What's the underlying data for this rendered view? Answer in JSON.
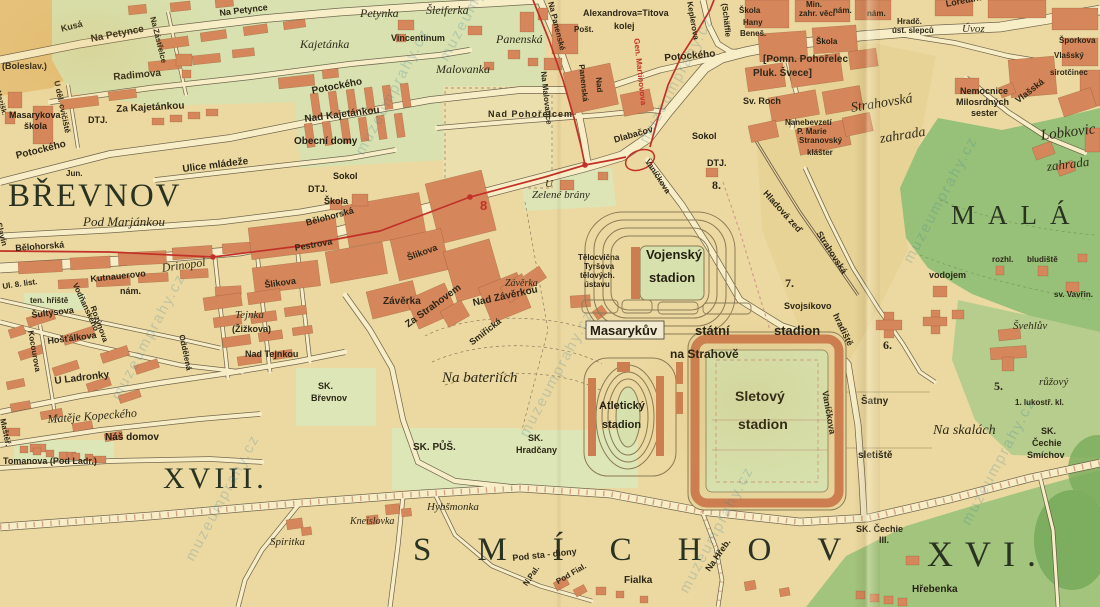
{
  "map": {
    "type": "historical-city-plan",
    "city_area": "Praha – Břevnov, Strahov, Smíchov, Malá Strana",
    "tram_line_number": "8",
    "watermark": {
      "text": "muzeumprahy.cz",
      "spots": [
        [
          108,
          395
        ],
        [
          352,
          150
        ],
        [
          636,
          138
        ],
        [
          516,
          432
        ],
        [
          182,
          556
        ],
        [
          900,
          258
        ],
        [
          676,
          588
        ],
        [
          436,
          56
        ],
        [
          958,
          520
        ]
      ]
    },
    "district_labels": [
      "BŘEVNOV",
      "MALÁ",
      "SMÍCHOV",
      "XVI.",
      "XVIII."
    ],
    "district_numbers": [
      "5.",
      "6.",
      "7.",
      "8."
    ],
    "colors": {
      "paper": "#ecd9a1",
      "block_green": "#d8e1af",
      "field_green": "#dde6b6",
      "park_green": "#97c078",
      "dark_park": "#7dad5e",
      "building": "#d5865a",
      "stand": "#cd7e50",
      "road": "#f7eec8",
      "tram_red": "#c23128",
      "ink": "#2d2718"
    }
  },
  "labels": [
    {
      "t": "BŘEVNOV",
      "x": 8,
      "y": 180,
      "fs": 33,
      "c": "big",
      "ls": 2
    },
    {
      "t": "MALÁ",
      "x": 951,
      "y": 202,
      "fs": 27,
      "c": "big",
      "ls": 13
    },
    {
      "t": "SMÍCHOV",
      "x": 413,
      "y": 534,
      "fs": 33,
      "c": "big",
      "ls": 46
    },
    {
      "t": "XVI.",
      "x": 927,
      "y": 536,
      "fs": 36,
      "c": "big",
      "ls": 12
    },
    {
      "t": "XVIII.",
      "x": 163,
      "y": 464,
      "fs": 30,
      "c": "big",
      "ls": 4
    },
    {
      "t": "Petynka",
      "x": 360,
      "y": 7,
      "fs": 12,
      "c": "it"
    },
    {
      "t": "Šleiferka",
      "x": 426,
      "y": 4,
      "fs": 12,
      "c": "it"
    },
    {
      "t": "Kajetánka",
      "x": 300,
      "y": 38,
      "fs": 12,
      "c": "it"
    },
    {
      "t": "Panenská",
      "x": 496,
      "y": 33,
      "fs": 12,
      "c": "it"
    },
    {
      "t": "Malovanka",
      "x": 436,
      "y": 63,
      "fs": 12,
      "c": "it"
    },
    {
      "t": "Pod Marjánkou",
      "x": 83,
      "y": 215,
      "fs": 13,
      "c": "it"
    },
    {
      "t": "Drinopol",
      "x": 161,
      "y": 262,
      "fs": 12,
      "c": "it",
      "r": -8
    },
    {
      "t": "Tejnka",
      "x": 235,
      "y": 310,
      "fs": 11,
      "c": "it"
    },
    {
      "t": "Spiritka",
      "x": 270,
      "y": 537,
      "fs": 11,
      "c": "it"
    },
    {
      "t": "Kneislovka",
      "x": 350,
      "y": 517,
      "fs": 10,
      "c": "it"
    },
    {
      "t": "Hybšmonka",
      "x": 427,
      "y": 502,
      "fs": 11,
      "c": "it"
    },
    {
      "t": "Na bateriích",
      "x": 442,
      "y": 371,
      "fs": 15,
      "c": "it"
    },
    {
      "t": "Na skalách",
      "x": 933,
      "y": 424,
      "fs": 14,
      "c": "it"
    },
    {
      "t": "růžový",
      "x": 1039,
      "y": 377,
      "fs": 11,
      "c": "it"
    },
    {
      "t": "Švehlův",
      "x": 1013,
      "y": 321,
      "fs": 11,
      "c": "it"
    },
    {
      "t": "Strahovská",
      "x": 850,
      "y": 102,
      "fs": 14,
      "c": "it",
      "r": -9
    },
    {
      "t": "zahrada",
      "x": 879,
      "y": 133,
      "fs": 14,
      "c": "it",
      "r": -9
    },
    {
      "t": "Lobkovic",
      "x": 1040,
      "y": 129,
      "fs": 15,
      "c": "it",
      "r": -7
    },
    {
      "t": "zahrada",
      "x": 1046,
      "y": 160,
      "fs": 13,
      "c": "it",
      "r": -7
    },
    {
      "t": "U",
      "x": 545,
      "y": 179,
      "fs": 11,
      "c": "it"
    },
    {
      "t": "Zelené brány",
      "x": 532,
      "y": 190,
      "fs": 11,
      "c": "it"
    },
    {
      "t": "Závěrka",
      "x": 505,
      "y": 279,
      "fs": 10,
      "c": "it"
    },
    {
      "t": "Úvoz",
      "x": 962,
      "y": 24,
      "fs": 11,
      "c": "it"
    },
    {
      "t": "Matěje Kopeckého",
      "x": 47,
      "y": 413,
      "fs": 12,
      "c": "it",
      "r": -4
    },
    {
      "t": "Kusá",
      "x": 60,
      "y": 25,
      "fs": 9,
      "c": "st",
      "r": -14
    },
    {
      "t": "Na Petynce",
      "x": 90,
      "y": 35,
      "fs": 10,
      "c": "st",
      "r": -11
    },
    {
      "t": "Na Petynce",
      "x": 219,
      "y": 9,
      "fs": 9,
      "c": "st",
      "r": -7
    },
    {
      "t": "(Boleslav.)",
      "x": 2,
      "y": 62,
      "fs": 9,
      "c": "st"
    },
    {
      "t": "Radimova",
      "x": 113,
      "y": 73,
      "fs": 10,
      "c": "st",
      "r": -5
    },
    {
      "t": "Za Kajetánkou",
      "x": 116,
      "y": 105,
      "fs": 10,
      "c": "st",
      "r": -3
    },
    {
      "t": "Vincentinum",
      "x": 391,
      "y": 34,
      "fs": 9,
      "c": "st"
    },
    {
      "t": "Potockého",
      "x": 311,
      "y": 87,
      "fs": 10,
      "c": "st",
      "r": -11
    },
    {
      "t": "Nad Kajetánkou",
      "x": 304,
      "y": 115,
      "fs": 10,
      "c": "st",
      "r": -7
    },
    {
      "t": "Ulice mládeže",
      "x": 182,
      "y": 165,
      "fs": 10,
      "c": "st",
      "r": -7
    },
    {
      "t": "Potockého",
      "x": 15,
      "y": 152,
      "fs": 10,
      "c": "st",
      "r": -14
    },
    {
      "t": "Jun.",
      "x": 66,
      "y": 170,
      "fs": 8,
      "c": "st"
    },
    {
      "t": "Bělohorská",
      "x": 15,
      "y": 244,
      "fs": 9,
      "c": "st",
      "r": -4
    },
    {
      "t": "Bělohorská",
      "x": 305,
      "y": 219,
      "fs": 9,
      "c": "st",
      "r": -15
    },
    {
      "t": "Pestrova",
      "x": 294,
      "y": 244,
      "fs": 9,
      "c": "st",
      "r": -10
    },
    {
      "t": "Šlikova",
      "x": 264,
      "y": 281,
      "fs": 9,
      "c": "st",
      "r": -8
    },
    {
      "t": "Šlikova",
      "x": 406,
      "y": 254,
      "fs": 9,
      "c": "st",
      "r": -20
    },
    {
      "t": "Za Strahovem",
      "x": 404,
      "y": 322,
      "fs": 10,
      "c": "st",
      "r": -36
    },
    {
      "t": "Závěrka",
      "x": 383,
      "y": 297,
      "fs": 10,
      "c": "st"
    },
    {
      "t": "Nad Závěrkou",
      "x": 472,
      "y": 299,
      "fs": 10,
      "c": "st",
      "r": -12
    },
    {
      "t": "Smiřická",
      "x": 468,
      "y": 340,
      "fs": 9,
      "c": "st",
      "r": -38
    },
    {
      "t": "Ul. 8. list.",
      "x": 2,
      "y": 283,
      "fs": 8,
      "c": "st",
      "r": -8
    },
    {
      "t": "ten. hřiště",
      "x": 30,
      "y": 297,
      "fs": 8,
      "c": "st"
    },
    {
      "t": "Šultysova",
      "x": 31,
      "y": 311,
      "fs": 9,
      "c": "st",
      "r": -7
    },
    {
      "t": "Hošťálkova",
      "x": 47,
      "y": 337,
      "fs": 9,
      "c": "st",
      "r": -7
    },
    {
      "t": "Kutnauerovo",
      "x": 90,
      "y": 275,
      "fs": 9,
      "c": "st",
      "r": -6
    },
    {
      "t": "nám.",
      "x": 120,
      "y": 287,
      "fs": 9,
      "c": "st"
    },
    {
      "t": "Vodňanského",
      "x": 78,
      "y": 282,
      "fs": 8,
      "c": "st",
      "r": 65
    },
    {
      "t": "Rozýnova",
      "x": 96,
      "y": 305,
      "fs": 8,
      "c": "st",
      "r": 70
    },
    {
      "t": "Kocourova",
      "x": 34,
      "y": 330,
      "fs": 8,
      "c": "st",
      "r": 80
    },
    {
      "t": "U Ladronky",
      "x": 54,
      "y": 377,
      "fs": 10,
      "c": "st",
      "r": -7
    },
    {
      "t": "Náš domov",
      "x": 105,
      "y": 433,
      "fs": 10,
      "c": "bl"
    },
    {
      "t": "Tomanova (Pod Ladr.)",
      "x": 3,
      "y": 457,
      "fs": 9,
      "c": "st"
    },
    {
      "t": "Maštěř.",
      "x": 6,
      "y": 418,
      "fs": 8,
      "c": "st",
      "r": 78
    },
    {
      "t": "(Žižkova)",
      "x": 232,
      "y": 325,
      "fs": 9,
      "c": "st"
    },
    {
      "t": "Nad Tejnkou",
      "x": 245,
      "y": 350,
      "fs": 9,
      "c": "st"
    },
    {
      "t": "Oddělená",
      "x": 185,
      "y": 334,
      "fs": 8,
      "c": "st",
      "r": 78
    },
    {
      "t": "Slavín",
      "x": 2,
      "y": 222,
      "fs": 8,
      "c": "st",
      "r": 75
    },
    {
      "t": "Mezišk.",
      "x": 1,
      "y": 90,
      "fs": 7,
      "c": "st",
      "r": 75
    },
    {
      "t": "U děl. cvičiště",
      "x": 60,
      "y": 80,
      "fs": 8,
      "c": "st",
      "r": 78
    },
    {
      "t": "Na Zástřelce",
      "x": 156,
      "y": 16,
      "fs": 8,
      "c": "st",
      "r": 76
    },
    {
      "t": "SK.",
      "x": 318,
      "y": 382,
      "fs": 9,
      "c": "st"
    },
    {
      "t": "Břevnov",
      "x": 311,
      "y": 394,
      "fs": 9,
      "c": "st"
    },
    {
      "t": "SK. PŮŠ.",
      "x": 413,
      "y": 443,
      "fs": 10,
      "c": "st"
    },
    {
      "t": "SK.",
      "x": 528,
      "y": 434,
      "fs": 9,
      "c": "st"
    },
    {
      "t": "Hradčany",
      "x": 516,
      "y": 446,
      "fs": 9,
      "c": "st"
    },
    {
      "t": "Pod sta - diony",
      "x": 512,
      "y": 554,
      "fs": 9,
      "c": "st",
      "r": -6
    },
    {
      "t": "N.Pal.",
      "x": 522,
      "y": 583,
      "fs": 8,
      "c": "st",
      "r": -55
    },
    {
      "t": "Pod Fial.",
      "x": 555,
      "y": 579,
      "fs": 8,
      "c": "st",
      "r": -30
    },
    {
      "t": "Na Hřeb.",
      "x": 704,
      "y": 568,
      "fs": 9,
      "c": "st",
      "r": -55
    },
    {
      "t": "Fialka",
      "x": 624,
      "y": 576,
      "fs": 10,
      "c": "st"
    },
    {
      "t": "Hřebenka",
      "x": 912,
      "y": 585,
      "fs": 10,
      "c": "bl"
    },
    {
      "t": "SK. Čechie",
      "x": 856,
      "y": 525,
      "fs": 9,
      "c": "st"
    },
    {
      "t": "III.",
      "x": 879,
      "y": 536,
      "fs": 9,
      "c": "st"
    },
    {
      "t": "SK.",
      "x": 1041,
      "y": 427,
      "fs": 9,
      "c": "st"
    },
    {
      "t": "Čechie",
      "x": 1032,
      "y": 439,
      "fs": 9,
      "c": "st"
    },
    {
      "t": "Smíchov",
      "x": 1027,
      "y": 451,
      "fs": 9,
      "c": "st"
    },
    {
      "t": "1. lukostř. kl.",
      "x": 1015,
      "y": 399,
      "fs": 8,
      "c": "st"
    },
    {
      "t": "Šatny",
      "x": 861,
      "y": 397,
      "fs": 10,
      "c": "st"
    },
    {
      "t": "sletiště",
      "x": 858,
      "y": 451,
      "fs": 10,
      "c": "st"
    },
    {
      "t": "Svojsíkovo",
      "x": 784,
      "y": 302,
      "fs": 9,
      "c": "st"
    },
    {
      "t": "hradiště",
      "x": 839,
      "y": 312,
      "fs": 9,
      "c": "st",
      "r": 64
    },
    {
      "t": "Vaníčkova",
      "x": 829,
      "y": 390,
      "fs": 9,
      "c": "st",
      "r": 80
    },
    {
      "t": "Vaníčkova",
      "x": 650,
      "y": 158,
      "fs": 8,
      "c": "st",
      "r": 57
    },
    {
      "t": "Hladová zeď",
      "x": 768,
      "y": 189,
      "fs": 9,
      "c": "st",
      "r": 48
    },
    {
      "t": "Strahovská",
      "x": 822,
      "y": 230,
      "fs": 9,
      "c": "st",
      "r": 57
    },
    {
      "t": "vodojem",
      "x": 929,
      "y": 271,
      "fs": 9,
      "c": "st"
    },
    {
      "t": "rozhl.",
      "x": 992,
      "y": 256,
      "fs": 8,
      "c": "st"
    },
    {
      "t": "bludiště",
      "x": 1027,
      "y": 256,
      "fs": 8,
      "c": "st"
    },
    {
      "t": "sv. Vavřin.",
      "x": 1054,
      "y": 291,
      "fs": 8,
      "c": "st"
    },
    {
      "t": "Nemocnice",
      "x": 960,
      "y": 87,
      "fs": 9,
      "c": "st"
    },
    {
      "t": "Milosrdných",
      "x": 956,
      "y": 98,
      "fs": 9,
      "c": "st"
    },
    {
      "t": "sester",
      "x": 971,
      "y": 109,
      "fs": 9,
      "c": "st"
    },
    {
      "t": "Vlašská",
      "x": 1014,
      "y": 98,
      "fs": 9,
      "c": "st",
      "r": -38
    },
    {
      "t": "sirotčinec",
      "x": 1050,
      "y": 69,
      "fs": 8,
      "c": "st"
    },
    {
      "t": "Vlašský",
      "x": 1054,
      "y": 52,
      "fs": 8,
      "c": "st"
    },
    {
      "t": "Šporkova",
      "x": 1059,
      "y": 37,
      "fs": 8,
      "c": "st"
    },
    {
      "t": "Hradč.",
      "x": 897,
      "y": 18,
      "fs": 8,
      "c": "st"
    },
    {
      "t": "úst. slepců",
      "x": 892,
      "y": 27,
      "fs": 8,
      "c": "st"
    },
    {
      "t": "nám.",
      "x": 867,
      "y": 10,
      "fs": 8,
      "c": "st"
    },
    {
      "t": "Loretánská",
      "x": 945,
      "y": 0,
      "fs": 9,
      "c": "st",
      "r": -11
    },
    {
      "t": "Min.",
      "x": 806,
      "y": 1,
      "fs": 8,
      "c": "st"
    },
    {
      "t": "zahr. věcí",
      "x": 799,
      "y": 10,
      "fs": 8,
      "c": "st"
    },
    {
      "t": "nám.",
      "x": 833,
      "y": 7,
      "fs": 8,
      "c": "st"
    },
    {
      "t": "Škola",
      "x": 816,
      "y": 38,
      "fs": 8,
      "c": "bl"
    },
    {
      "t": "[Pomn. Pohořelec",
      "x": 763,
      "y": 55,
      "fs": 10,
      "c": "st"
    },
    {
      "t": "Pluk. Švece]",
      "x": 753,
      "y": 69,
      "fs": 10,
      "c": "st"
    },
    {
      "t": "Sv. Roch",
      "x": 743,
      "y": 97,
      "fs": 9,
      "c": "st"
    },
    {
      "t": "Nanebevzetí",
      "x": 785,
      "y": 119,
      "fs": 8,
      "c": "st"
    },
    {
      "t": "P. Marie",
      "x": 797,
      "y": 128,
      "fs": 8,
      "c": "st"
    },
    {
      "t": "Stranovský",
      "x": 799,
      "y": 137,
      "fs": 8,
      "c": "st"
    },
    {
      "t": "klášter",
      "x": 807,
      "y": 149,
      "fs": 8,
      "c": "st"
    },
    {
      "t": "Keplerova",
      "x": 693,
      "y": 1,
      "fs": 8,
      "c": "st",
      "r": 80
    },
    {
      "t": "(Schäffle",
      "x": 728,
      "y": 3,
      "fs": 8,
      "c": "st",
      "r": 84
    },
    {
      "t": "Škola",
      "x": 739,
      "y": 7,
      "fs": 8,
      "c": "st"
    },
    {
      "t": "Hany",
      "x": 743,
      "y": 19,
      "fs": 8,
      "c": "st"
    },
    {
      "t": "Beneš.",
      "x": 740,
      "y": 30,
      "fs": 8,
      "c": "st"
    },
    {
      "t": "Alexandrova=Titova",
      "x": 583,
      "y": 9,
      "fs": 9,
      "c": "st"
    },
    {
      "t": "kolej",
      "x": 614,
      "y": 22,
      "fs": 9,
      "c": "st"
    },
    {
      "t": "Pošt.",
      "x": 574,
      "y": 26,
      "fs": 8,
      "c": "st"
    },
    {
      "t": "Na Panenské",
      "x": 554,
      "y": 1,
      "fs": 8,
      "c": "st",
      "r": 76
    },
    {
      "t": "Panenská",
      "x": 585,
      "y": 64,
      "fs": 8,
      "c": "st",
      "r": 84
    },
    {
      "t": "Na Malovance",
      "x": 547,
      "y": 71,
      "fs": 8,
      "c": "st",
      "r": 84
    },
    {
      "t": "Nad",
      "x": 602,
      "y": 77,
      "fs": 8,
      "c": "st",
      "r": 85
    },
    {
      "t": "Nad Pohořelcem",
      "x": 488,
      "y": 110,
      "fs": 9,
      "c": "st",
      "ls": 1
    },
    {
      "t": "Dlabačov",
      "x": 613,
      "y": 136,
      "fs": 9,
      "c": "st",
      "r": -16
    },
    {
      "t": "Potockého",
      "x": 664,
      "y": 54,
      "fs": 10,
      "c": "st",
      "r": -5
    },
    {
      "t": "Gen. Martinovova",
      "x": 640,
      "y": 38,
      "fs": 8,
      "c": "red",
      "r": 84
    },
    {
      "t": "Sokol",
      "x": 333,
      "y": 172,
      "fs": 9,
      "c": "bl"
    },
    {
      "t": "Sokol",
      "x": 692,
      "y": 132,
      "fs": 9,
      "c": "bl"
    },
    {
      "t": "DTJ.",
      "x": 88,
      "y": 116,
      "fs": 9,
      "c": "bl"
    },
    {
      "t": "DTJ.",
      "x": 308,
      "y": 185,
      "fs": 9,
      "c": "bl"
    },
    {
      "t": "DTJ.",
      "x": 707,
      "y": 159,
      "fs": 9,
      "c": "bl"
    },
    {
      "t": "Škola",
      "x": 324,
      "y": 197,
      "fs": 9,
      "c": "bl"
    },
    {
      "t": "Masarykova",
      "x": 9,
      "y": 111,
      "fs": 9,
      "c": "bl"
    },
    {
      "t": "škola",
      "x": 24,
      "y": 122,
      "fs": 9,
      "c": "bl"
    },
    {
      "t": "Obecní domy",
      "x": 294,
      "y": 137,
      "fs": 10,
      "c": "bl"
    },
    {
      "t": "Tělocvična",
      "x": 578,
      "y": 254,
      "fs": 8,
      "c": "st"
    },
    {
      "t": "Tyršova",
      "x": 584,
      "y": 263,
      "fs": 8,
      "c": "st"
    },
    {
      "t": "tělových.",
      "x": 580,
      "y": 272,
      "fs": 8,
      "c": "st"
    },
    {
      "t": "ústavu",
      "x": 584,
      "y": 281,
      "fs": 8,
      "c": "st"
    },
    {
      "t": "Vojenský",
      "x": 646,
      "y": 248,
      "fs": 13,
      "c": "bl"
    },
    {
      "t": "stadion",
      "x": 649,
      "y": 271,
      "fs": 13,
      "c": "bl"
    },
    {
      "t": "Masarykův",
      "x": 590,
      "y": 324,
      "fs": 13,
      "c": "bl"
    },
    {
      "t": "státní",
      "x": 695,
      "y": 324,
      "fs": 13,
      "c": "bl"
    },
    {
      "t": "stadion",
      "x": 774,
      "y": 324,
      "fs": 13,
      "c": "bl"
    },
    {
      "t": "na Strahově",
      "x": 670,
      "y": 348,
      "fs": 12,
      "c": "bl"
    },
    {
      "t": "Atletický",
      "x": 599,
      "y": 401,
      "fs": 11,
      "c": "bl"
    },
    {
      "t": "stadion",
      "x": 602,
      "y": 420,
      "fs": 11,
      "c": "bl"
    },
    {
      "t": "Sletový",
      "x": 735,
      "y": 389,
      "fs": 14,
      "c": "bl"
    },
    {
      "t": "stadion",
      "x": 738,
      "y": 417,
      "fs": 14,
      "c": "bl"
    },
    {
      "t": "7.",
      "x": 785,
      "y": 277,
      "fs": 12,
      "c": "num"
    },
    {
      "t": "8.",
      "x": 712,
      "y": 179,
      "fs": 12,
      "c": "num"
    },
    {
      "t": "6.",
      "x": 883,
      "y": 339,
      "fs": 12,
      "c": "num"
    },
    {
      "t": "5.",
      "x": 994,
      "y": 380,
      "fs": 12,
      "c": "num"
    },
    {
      "t": "8",
      "x": 480,
      "y": 199,
      "fs": 13,
      "c": "red"
    }
  ]
}
